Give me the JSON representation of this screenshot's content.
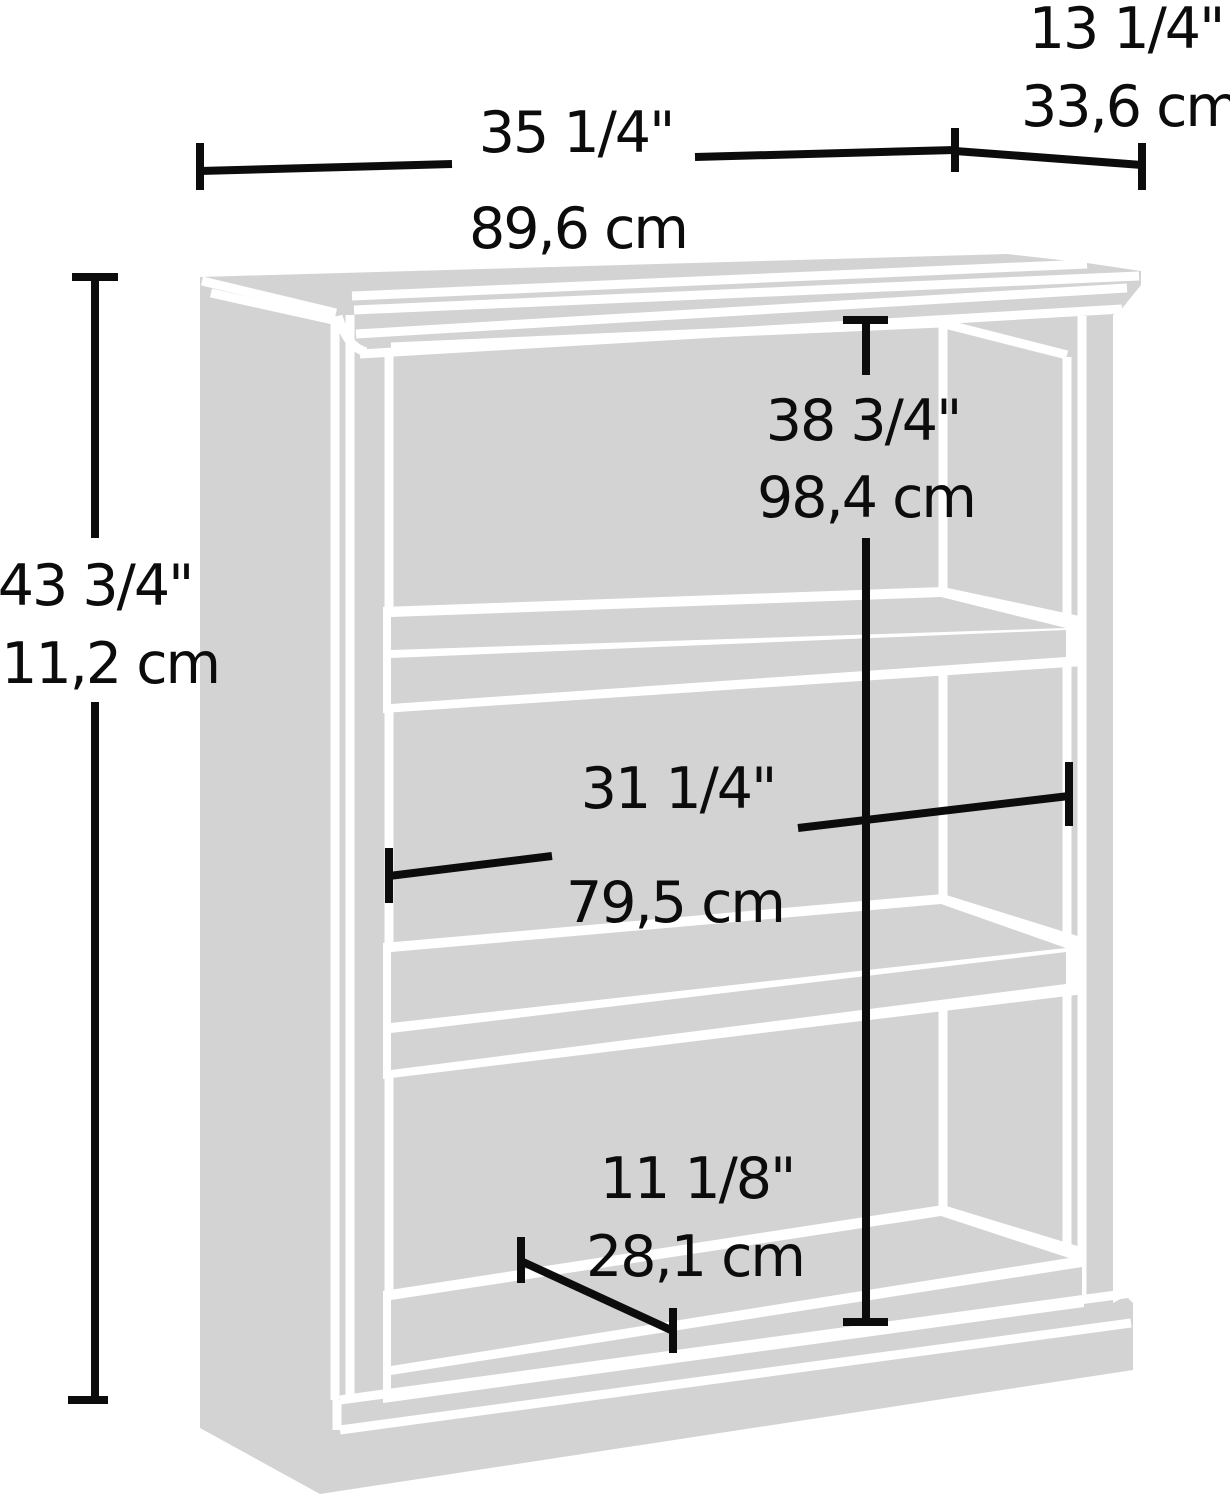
{
  "diagram": {
    "type": "furniture-dimension-diagram",
    "product": "3-shelf bookcase line illustration",
    "colors": {
      "artwork_gray": "#d3d3d3",
      "separator_white": "#ffffff",
      "dimension_black": "#0c0c0c",
      "background": "#ffffff"
    },
    "dimensions": {
      "overall_width": {
        "inches": "35 1/4\"",
        "cm": "89,6 cm"
      },
      "overall_depth": {
        "inches": "13 1/4\"",
        "cm": "33,6 cm"
      },
      "overall_height": {
        "inches": "43 3/4\"",
        "cm": "111,2 cm"
      },
      "interior_height": {
        "inches": "38 3/4\"",
        "cm": "98,4 cm"
      },
      "interior_width": {
        "inches": "31 1/4\"",
        "cm": "79,5 cm"
      },
      "shelf_depth": {
        "inches": "11 1/8\"",
        "cm": "28,1 cm"
      }
    }
  }
}
